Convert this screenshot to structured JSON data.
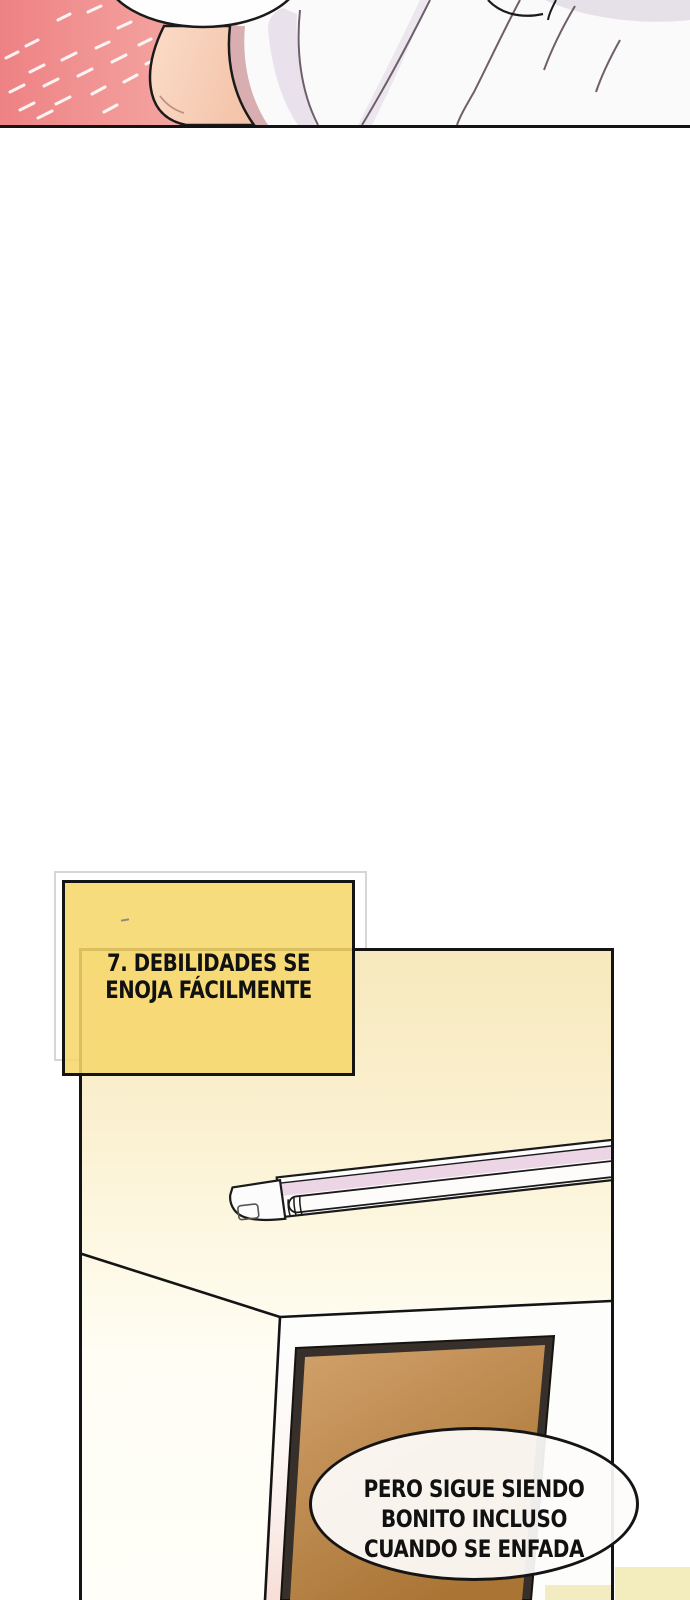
{
  "comic": {
    "chapter_box": {
      "line1": "7. DEBILIDADES SE",
      "line2": "ENOJA FÁCILMENTE",
      "fill_color": "#f6d76c",
      "border_color": "#141414"
    },
    "speech_bubble": {
      "line1": "PERO SIGUE SIENDO",
      "line2": "BONITO INCLUSO",
      "line3": "CUANDO SE ENFADA",
      "fill_color": "#fdfcfa",
      "border_color": "#141414"
    },
    "colors": {
      "flashback_pink_left": "#ee8184",
      "flashback_pink_right": "#fdf2ef",
      "skin": "#f8d2b9",
      "shirt_white": "#fbfafb",
      "room_wall_cream": "#f7e9bd",
      "front_wall_white": "#fdfdfc",
      "door_brown": "#c2905d",
      "door_frame_dark": "#37302a",
      "light_tube_pink": "#ecd5e5",
      "next_panel_cream": "#f3ecbd"
    }
  }
}
